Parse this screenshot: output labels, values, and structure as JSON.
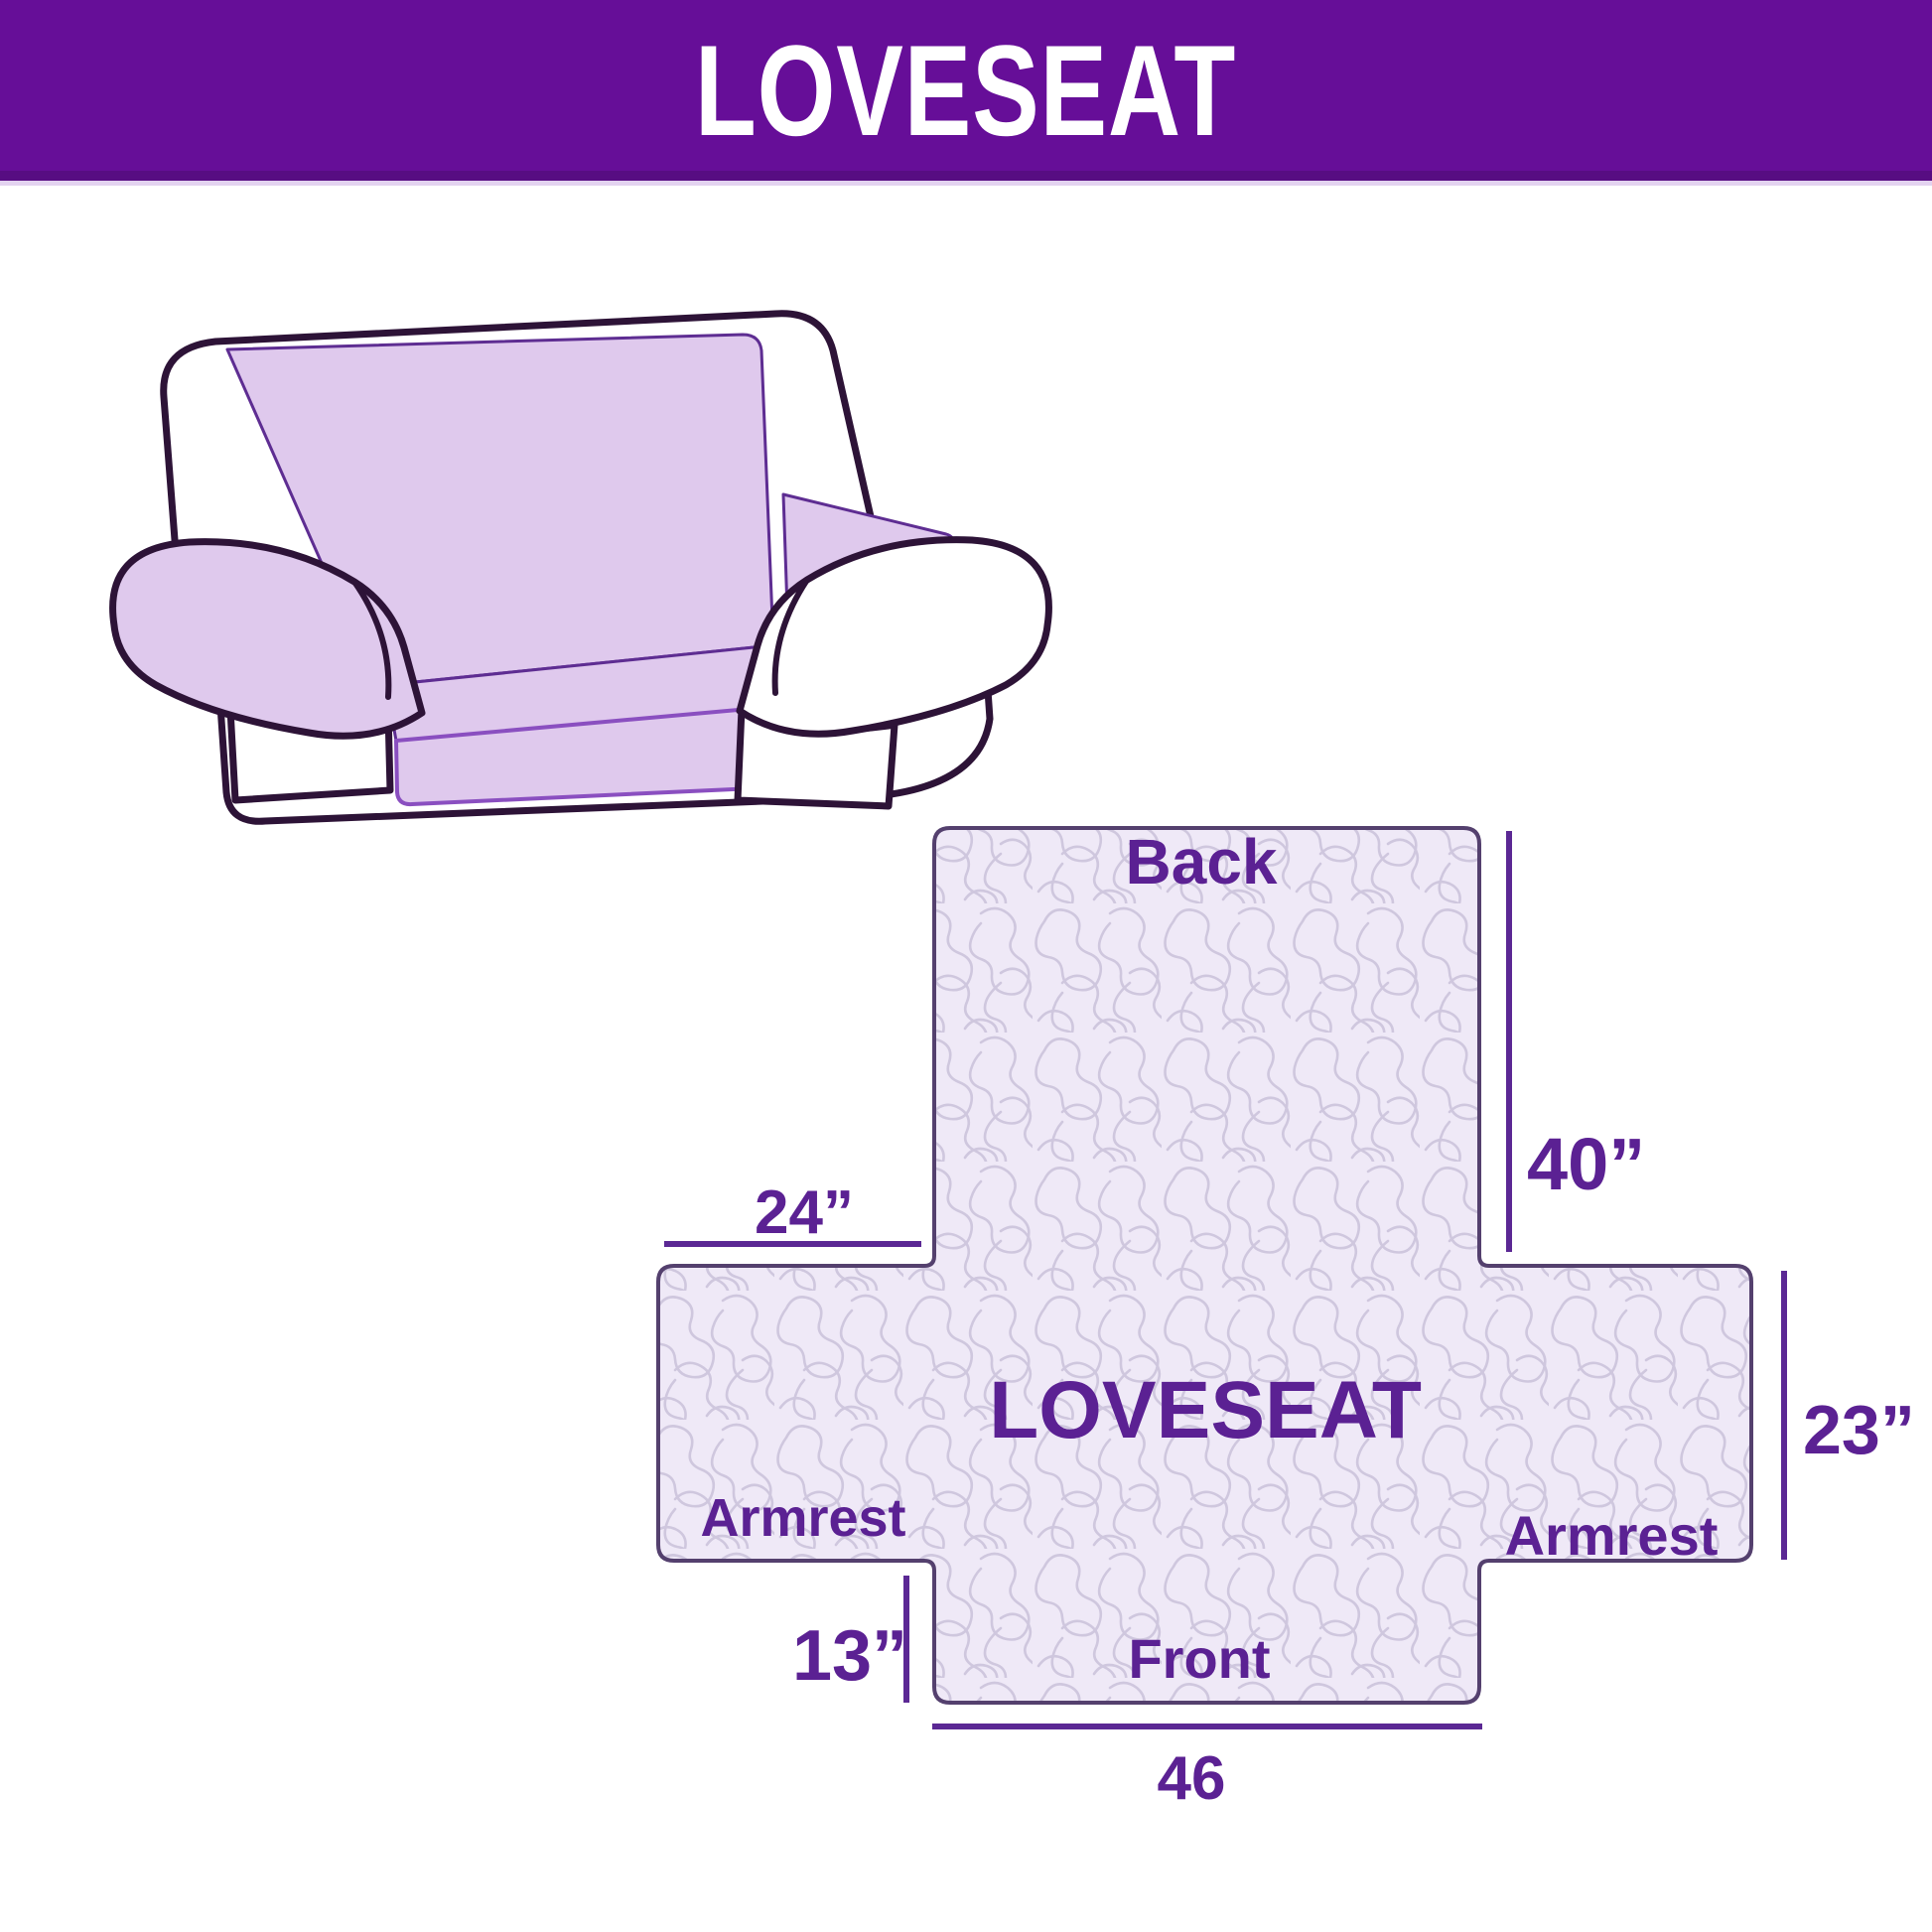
{
  "header": {
    "title": "LOVESEAT"
  },
  "illustration": {
    "name": "loveseat-sofa-with-lavender-slipcover"
  },
  "diagram": {
    "center_label": "LOVESEAT",
    "back_label": "Back",
    "front_label": "Front",
    "armrest_left_label": "Armrest",
    "armrest_right_label": "Armrest",
    "dims": {
      "back_height": "40”",
      "armrest_top_width": "24”",
      "armrest_side_height": "23”",
      "front_side_height": "13”",
      "front_width": "46"
    }
  },
  "colors": {
    "header_background": "#660E98",
    "header_text": "#FFFFFF",
    "label_purple": "#5B2193",
    "dimension_line_purple": "#5B2894",
    "diagram_outline": "#54406E",
    "diagram_fill": "#EFE9F7",
    "quilt_pattern_line": "#CFC7DE",
    "sofa_cover_lavender": "#DFC9ED",
    "sofa_cover_edge": "#8A4FC0",
    "sofa_outline": "#2D1337",
    "background": "#FFFFFF"
  }
}
